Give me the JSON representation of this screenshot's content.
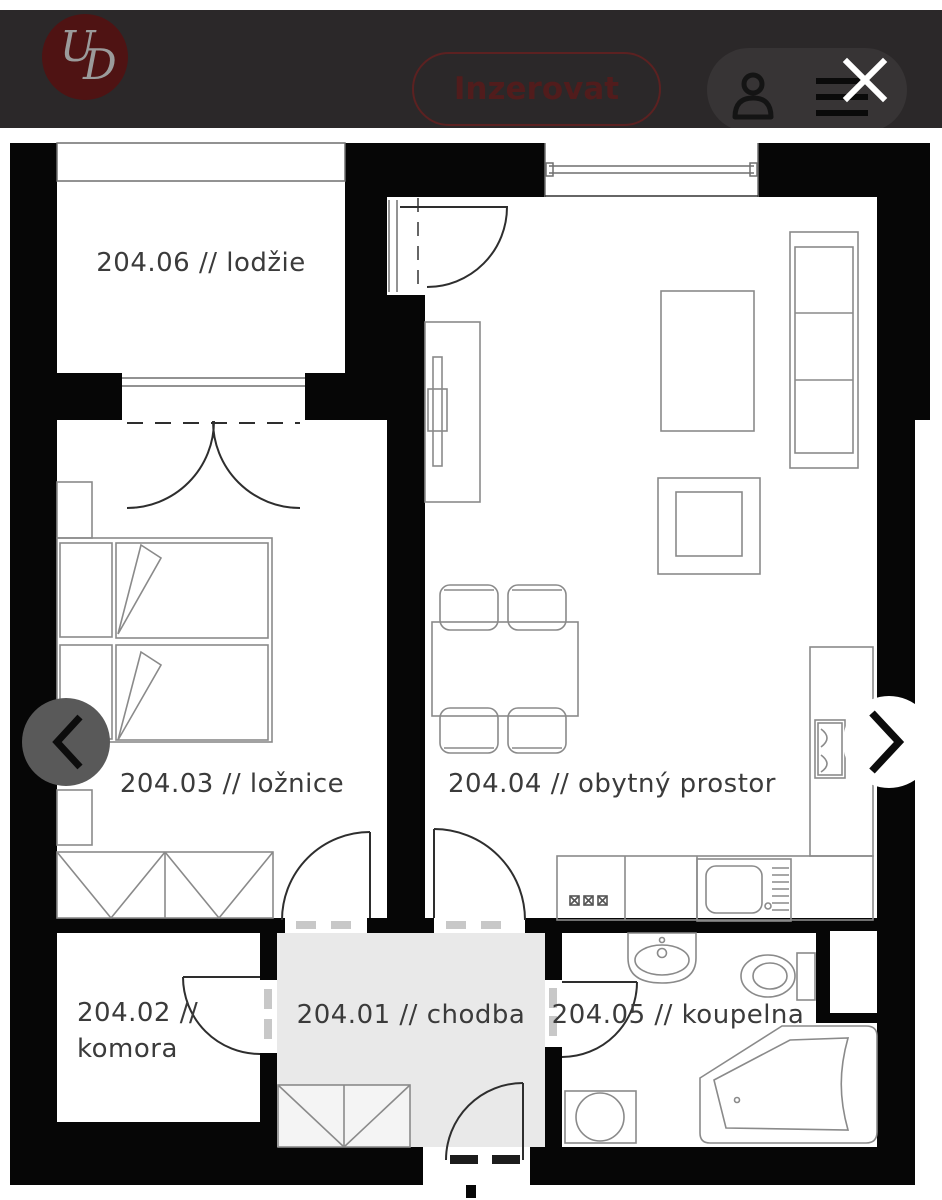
{
  "header": {
    "logo_u": "U",
    "logo_d": "D",
    "cta_label": "Inzerovat"
  },
  "floorplan": {
    "rooms": {
      "lodzie": "204.06 // lodžie",
      "loznice": "204.03 // ložnice",
      "obytny_prostor": "204.04 // obytný prostor",
      "komora_line1": "204.02 //",
      "komora_line2": "komora",
      "chodba": "204.01 // chodba",
      "koupelna": "204.05 // koupelna"
    }
  },
  "colors": {
    "header_bg": "#2b2829",
    "brand_red": "#511c1c",
    "logo_circle": "#4f1313",
    "wall_black": "#060606",
    "hallway_fill": "#e9e9e9",
    "left_arrow_circle": "#595959",
    "right_arrow_circle": "#ffffff"
  }
}
